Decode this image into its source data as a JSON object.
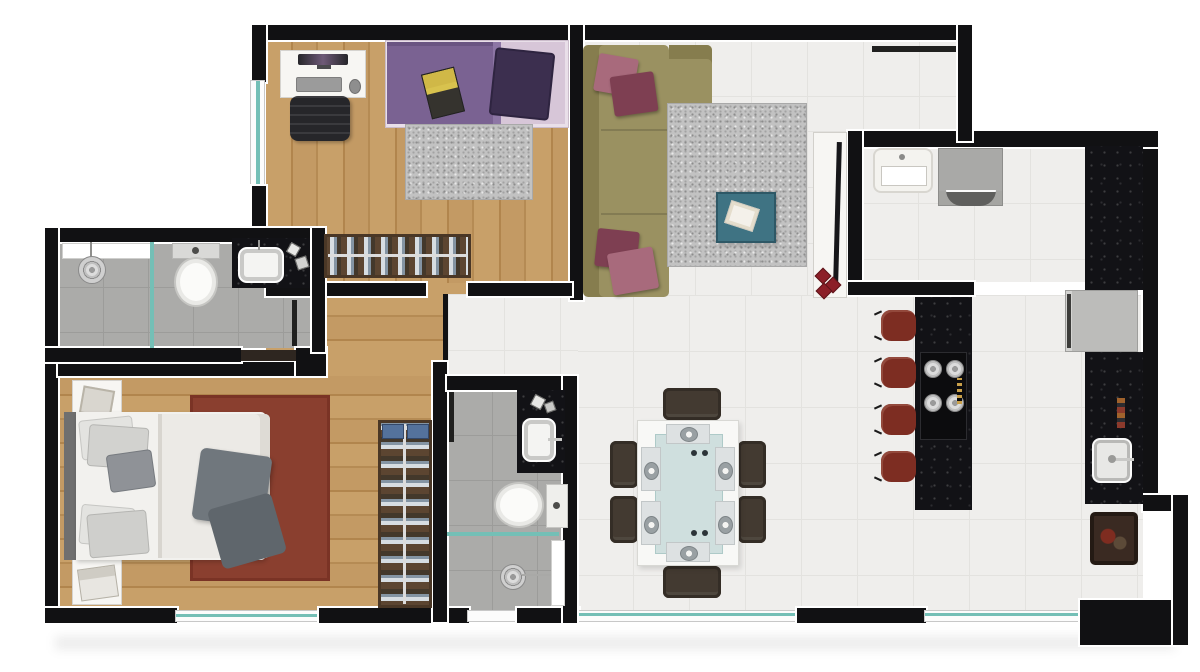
{
  "plan_type": "apartment-floor-plan-top-view",
  "colors": {
    "wall": "#111113",
    "wood1": "#c8a069",
    "wood2": "#b58b54",
    "tile": "#efeeec",
    "bathtile": "#ababa9",
    "glass": "#74bfb6",
    "sofa": "#9a9161",
    "sofaback": "#867d4e",
    "cushion1": "#a86a7c",
    "cushion2": "#7e3f52",
    "ruggray": "#c2c2c2",
    "rugred": "#8a3f2f",
    "tableteal": "#3f7383",
    "chair": "#433a31",
    "stool": "#7d2d22",
    "granite": "#121216",
    "fridge": "#bcbcba",
    "washer": "#a9a9a7",
    "closet": "#5c4531",
    "bedpurple": "#7a6292",
    "pillowpurple": "#3c2f4f",
    "sheetpink": "#d7c6d8",
    "blanket": "#70777d",
    "furnwhite": "#f7f6f3",
    "headboard": "#6f6f6f",
    "decorred": "#8c1f28"
  },
  "rooms": [
    {
      "name": "single-bedroom",
      "floor": "wood",
      "contents": [
        "desk-with-monitor-keyboard-mouse",
        "office-chair",
        "single-bed-purple",
        "gray-shag-rug",
        "closet-with-hanging-clothes",
        "window"
      ]
    },
    {
      "name": "living-room",
      "floor": "light-tile",
      "contents": [
        "l-shaped-olive-sofa",
        "maroon-cushions",
        "gray-shag-rug",
        "teal-coffee-table-with-book",
        "white-tv-console",
        "tv",
        "entry-door"
      ]
    },
    {
      "name": "laundry-area",
      "floor": "light-tile",
      "contents": [
        "laundry-tank-sink",
        "washing-machine",
        "black-granite-counter"
      ]
    },
    {
      "name": "kitchen",
      "floor": "light-tile",
      "contents": [
        "granite-island-with-cooktop",
        "bar-stools",
        "refrigerator",
        "granite-counter-with-sink",
        "dark-mat"
      ]
    },
    {
      "name": "dining-area",
      "floor": "light-tile",
      "contents": [
        "glass-dining-table",
        "dining-chairs",
        "place-settings"
      ]
    },
    {
      "name": "bathroom-1",
      "floor": "gray-tile",
      "contents": [
        "shower-with-drain",
        "glass-partition",
        "toilet",
        "granite-vanity-with-sink",
        "wall-niche",
        "door"
      ]
    },
    {
      "name": "master-bedroom",
      "floor": "wood",
      "contents": [
        "double-bed",
        "nightstand-top",
        "nightstand-bottom",
        "red-rug",
        "wardrobe-with-hanging-clothes",
        "window"
      ]
    },
    {
      "name": "bathroom-2",
      "floor": "gray-tile",
      "contents": [
        "granite-vanity-with-sink",
        "toilet",
        "glass-partition",
        "shower-with-drain",
        "wall-niche",
        "door"
      ]
    },
    {
      "name": "hallway",
      "floor": "wood",
      "contents": []
    }
  ],
  "counts": {
    "bar_stools": 4,
    "dining_chairs": 6,
    "cooktop_burners": 4,
    "dining_place_settings": 6,
    "bedrooms": 2,
    "bathrooms": 2
  }
}
